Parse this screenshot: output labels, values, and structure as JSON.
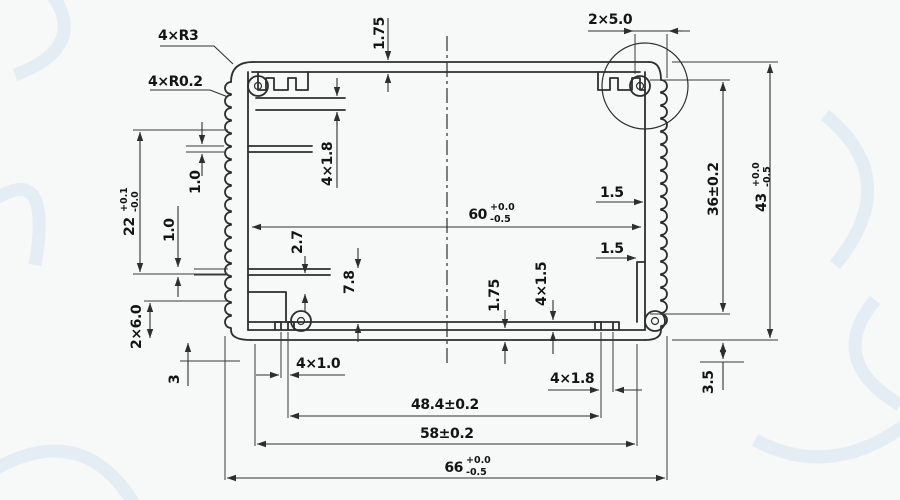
{
  "drawing": {
    "type": "extrusion-profile-cross-section",
    "line_color": "#2e2e2e",
    "background_color": "#f7f8f8",
    "watermark_color": "#d9e6f2"
  },
  "labels": {
    "corner_radius": "4×R3",
    "fin_tip_radius": "4×R0.2",
    "top_wall_thickness": "1.75",
    "corner_slot_width": "2×5.0",
    "left_inner_height": {
      "nominal": "22",
      "plus": "+0.1",
      "minus": "-0.0"
    },
    "left_rib_upper": "1.0",
    "left_rib_lower": "1.0",
    "top_rail_depth": "4×1.8",
    "inner_width": {
      "nominal": "60",
      "plus": "+0.0",
      "minus": "-0.5"
    },
    "right_web_upper": "1.5",
    "right_web_lower": "1.5",
    "inner_height": "36±0.2",
    "outer_height": {
      "nominal": "43",
      "plus": "+0.0",
      "minus": "-0.5"
    },
    "pocket_step": "2.7",
    "pocket_depth": "7.8",
    "bottom_wall_thickness": "1.75",
    "bottom_rail_height": "4×1.5",
    "side_slot_height": "2×6.0",
    "bottom_left_offset": "3",
    "bottom_rail_gap_left": "4×1.0",
    "bottom_rail_gap_right": "4×1.8",
    "bottom_right_offset": "3.5",
    "screw_boss_span": "48.4±0.2",
    "rail_span": "58±0.2",
    "outer_width": {
      "nominal": "66",
      "plus": "+0.0",
      "minus": "-0.5"
    }
  }
}
